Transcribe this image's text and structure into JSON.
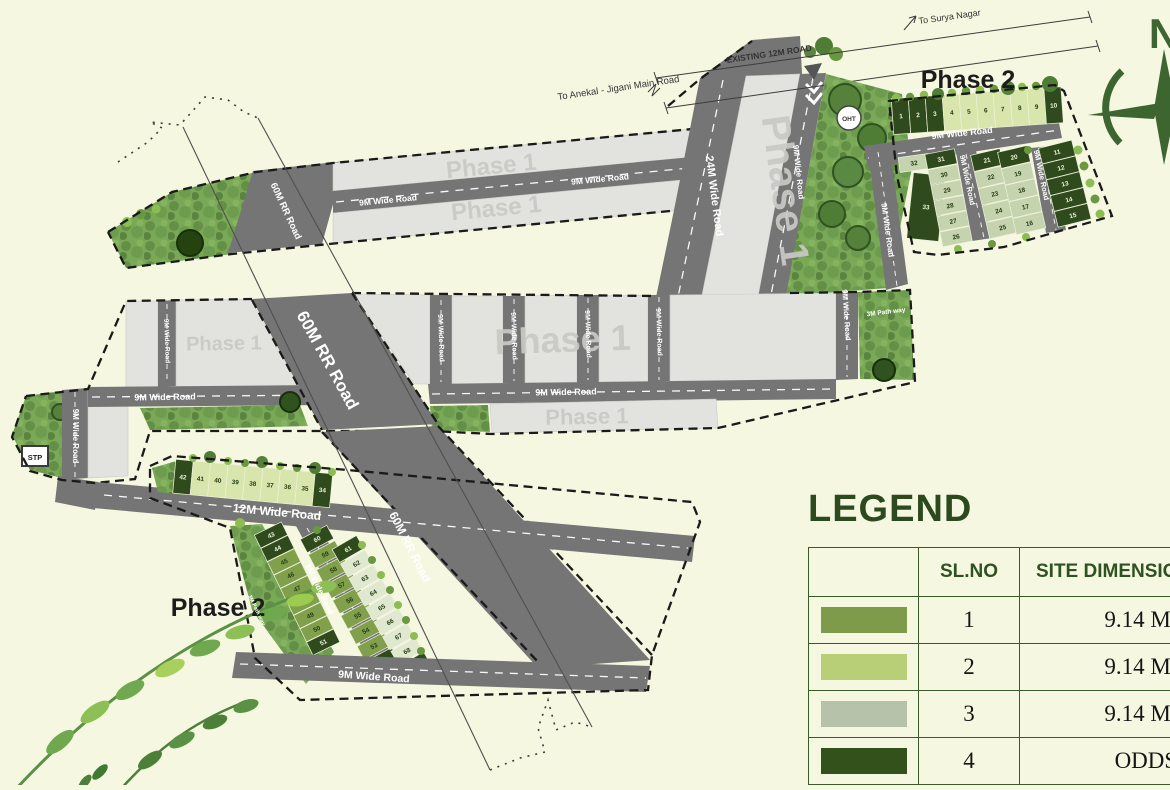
{
  "labels": {
    "phase1": "Phase 1",
    "phase2": "Phase 2",
    "north": "N",
    "oht": "OHT",
    "stp": "STP",
    "to_surya": "To Surya Nagar",
    "to_anekal": "To Anekal - Jigani Main Road"
  },
  "roads": {
    "existing": "EXISTING 12M ROAD",
    "r24": "24M Wide Road",
    "r60": "60M RR Road",
    "r12": "12M Wide Road",
    "r9": "9M Wide Road",
    "path3": "3M Path way"
  },
  "legend": {
    "title": "LEGEND",
    "headers": {
      "slno": "SL.NO",
      "dims": "SITE DIMENSIONS"
    },
    "rows": [
      {
        "slno": "1",
        "dims": "9.14 M X 12.",
        "color": "#7d9b4a"
      },
      {
        "slno": "2",
        "dims": "9.14 M X 13.",
        "color": "#b9cf77"
      },
      {
        "slno": "3",
        "dims": "9.14 M X 15.",
        "color": "#b7c2ab"
      },
      {
        "slno": "4",
        "dims": "ODDS SIT",
        "color": "#33511a"
      }
    ]
  },
  "plot_colors": {
    "d": "#2f4a1d",
    "p": "#c5d3af",
    "l": "#d8e5ac",
    "m": "#81a04b",
    "w": "#e0e8cf"
  },
  "plots": {
    "ne": {
      "top_row": {
        "nums": [
          "1",
          "2",
          "3",
          "4",
          "5",
          "6",
          "7",
          "8",
          "9",
          "10"
        ],
        "colors": [
          "d",
          "d",
          "d",
          "l",
          "l",
          "l",
          "l",
          "l",
          "l",
          "d"
        ]
      },
      "plot_32": {
        "nums": [
          "32"
        ],
        "colors": [
          "p"
        ]
      },
      "plot_33": {
        "nums": [
          "33"
        ],
        "colors": [
          "d"
        ]
      },
      "col_a": {
        "nums": [
          "31",
          "30",
          "29",
          "28",
          "27",
          "26"
        ],
        "colors": [
          "d",
          "p",
          "p",
          "p",
          "p",
          "p"
        ]
      },
      "col_b": {
        "nums": [
          "21",
          "22",
          "23",
          "24",
          "25"
        ],
        "colors": [
          "d",
          "p",
          "p",
          "p",
          "p"
        ]
      },
      "col_c": {
        "nums": [
          "20",
          "19",
          "18",
          "17",
          "16"
        ],
        "colors": [
          "d",
          "p",
          "p",
          "p",
          "p"
        ]
      },
      "col_d": {
        "nums": [
          "11",
          "12",
          "13",
          "14",
          "15"
        ],
        "colors": [
          "d",
          "d",
          "d",
          "d",
          "d"
        ]
      }
    },
    "sw": {
      "top_row": {
        "nums": [
          "42",
          "41",
          "40",
          "39",
          "38",
          "37",
          "36",
          "35",
          "34"
        ],
        "colors": [
          "d",
          "l",
          "l",
          "l",
          "l",
          "l",
          "l",
          "l",
          "d"
        ]
      },
      "col_l": {
        "nums": [
          "43",
          "44",
          "45",
          "46",
          "47",
          "48",
          "49",
          "50",
          "51"
        ],
        "colors": [
          "d",
          "d",
          "m",
          "m",
          "m",
          "m",
          "m",
          "m",
          "d"
        ]
      },
      "col_m": {
        "nums": [
          "60",
          "59",
          "58",
          "57",
          "56",
          "55",
          "54",
          "53",
          "52"
        ],
        "colors": [
          "d",
          "m",
          "m",
          "m",
          "m",
          "m",
          "m",
          "m",
          "d"
        ]
      },
      "col_r": {
        "nums": [
          "61",
          "62",
          "63",
          "64",
          "65",
          "66",
          "67",
          "68",
          "69"
        ],
        "colors": [
          "d",
          "w",
          "w",
          "w",
          "w",
          "w",
          "w",
          "w",
          "d"
        ]
      }
    }
  }
}
